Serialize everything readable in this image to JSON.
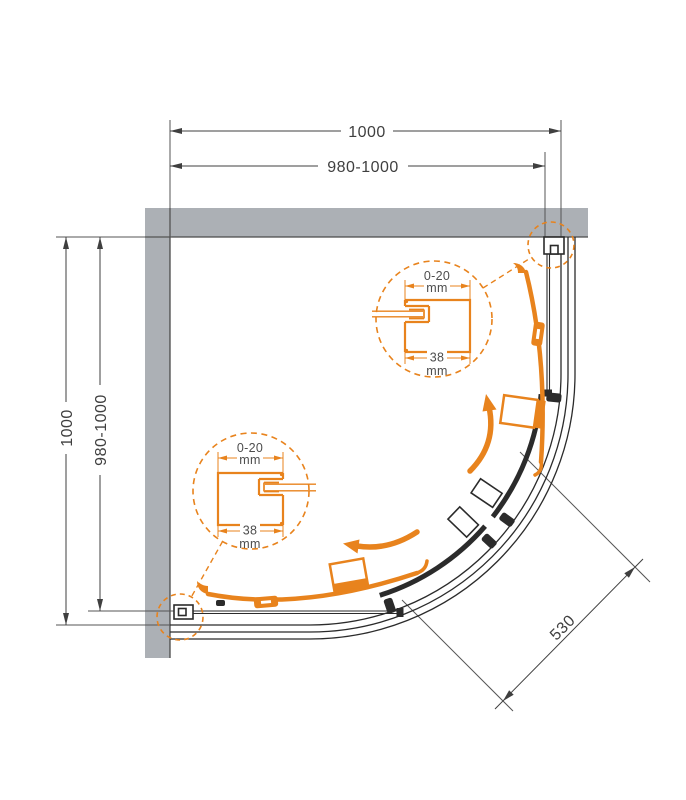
{
  "drawing": {
    "type": "quadrant-shower-enclosure-top-view",
    "colors": {
      "accent_orange": "#E8831D",
      "wall_gray": "#ACB0B5",
      "line_dark": "#2B2B2B",
      "dim_line": "#3F3F3F",
      "text": "#4D4D4D"
    },
    "dimensions": {
      "top_total": "1000",
      "top_adjust": "980-1000",
      "left_total": "1000",
      "left_adjust": "980-1000",
      "door_opening": "530"
    },
    "detail_top": {
      "range": "0-20",
      "range_unit": "mm",
      "depth": "38",
      "depth_unit": "mm"
    },
    "detail_bottom": {
      "range": "0-20",
      "range_unit": "mm",
      "depth": "38",
      "depth_unit": "mm"
    }
  }
}
